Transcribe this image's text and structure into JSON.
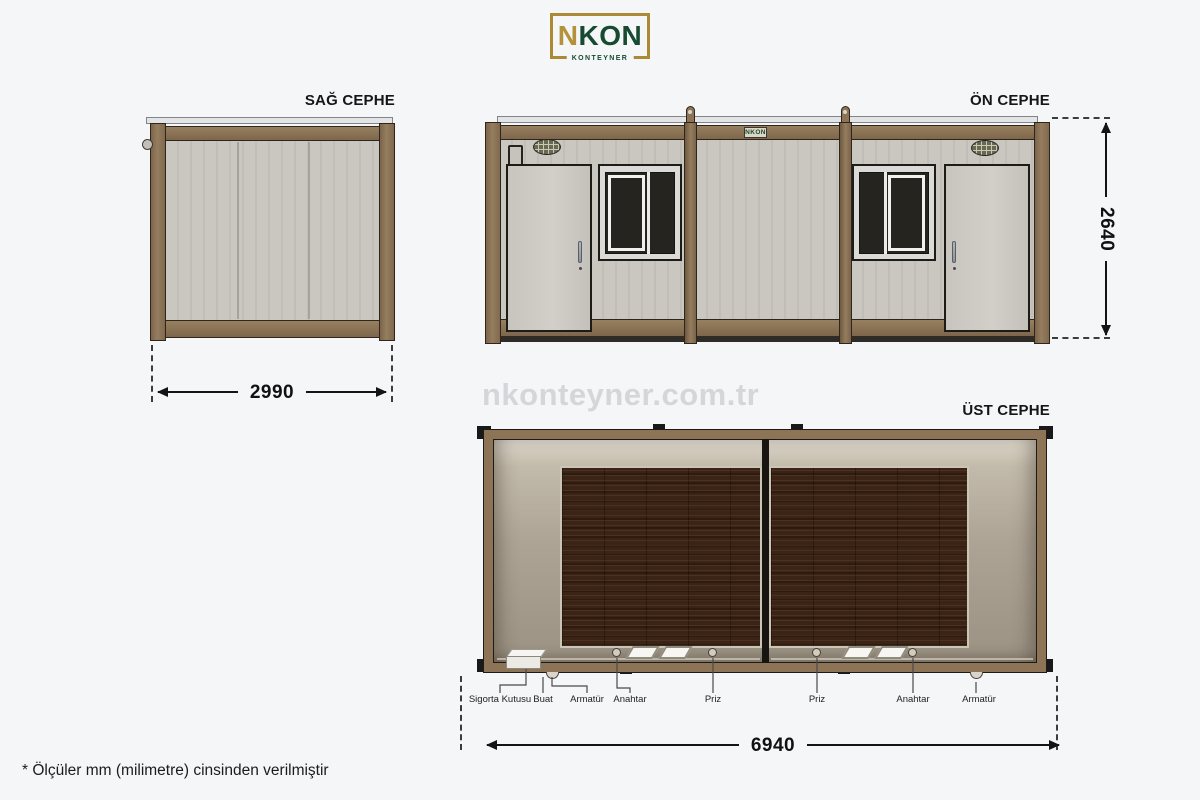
{
  "brand": {
    "logo_main_n": "N",
    "logo_main_rest": "KON",
    "logo_sub": "KONTEYNER",
    "plate": "NKON"
  },
  "views": {
    "right_facade": {
      "label": "SAĞ CEPHE",
      "width_dim": "2990"
    },
    "front_facade": {
      "label": "ÖN CEPHE",
      "height_dim": "2640"
    },
    "top_facade": {
      "label": "ÜST CEPHE",
      "length_dim": "6940"
    }
  },
  "plan_labels": {
    "fuse_box": "Sigorta Kutusu",
    "junction_box": "Buat",
    "fixture_left": "Armatür",
    "switch_left": "Anahtar",
    "socket_left": "Priz",
    "socket_right": "Priz",
    "switch_right": "Anahtar",
    "fixture_right": "Armatür"
  },
  "watermark": "nkonteyner.com.tr",
  "footnote": "* Ölçüler mm (milimetre) cinsinden verilmiştir",
  "colors": {
    "background": "#f5f6f8",
    "frame_brown": "#8d7457",
    "panel_gray": "#c9c6c0",
    "wood_floor": "#3b2315",
    "logo_gold": "#ab8a33",
    "logo_green": "#174b31"
  }
}
